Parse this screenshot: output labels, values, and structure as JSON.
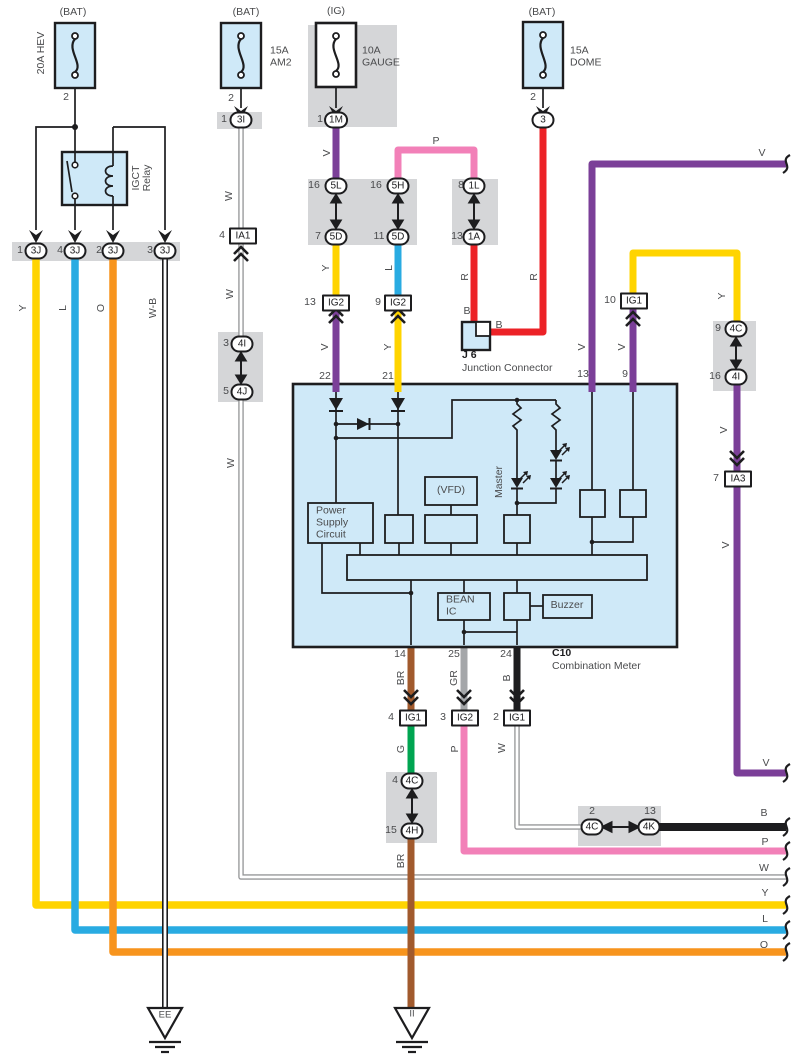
{
  "title": "Combination Meter Wiring Diagram",
  "colors": {
    "yellow": "#FFD400",
    "blue": "#29ABE2",
    "orange": "#F7941D",
    "purple": "#7B3F98",
    "pink": "#F280B8",
    "red": "#EC2227",
    "green": "#00A551",
    "brown": "#A15A2D",
    "gray": "#A4A6A9",
    "black": "#1D1D1F",
    "panel": "#CFE9F8",
    "band": "#D5D6D8",
    "whitewire": "#97989A",
    "line": "#1D1D1F",
    "text": "#4A4B4D"
  },
  "labels": [
    {
      "id": "bat-hev",
      "t": "(BAT)",
      "x": 73,
      "y": 13
    },
    {
      "id": "hev-rating",
      "t": "20A HEV",
      "x": 42,
      "y": 53,
      "c": "r"
    },
    {
      "id": "hev-pin2",
      "t": "2",
      "x": 66,
      "y": 98
    },
    {
      "id": "bat-am2",
      "t": "(BAT)",
      "x": 246,
      "y": 13
    },
    {
      "id": "am2-rating",
      "t": "15A\nAM2",
      "x": 270,
      "y": 57,
      "c": "pre lft"
    },
    {
      "id": "am2-pin2",
      "t": "2",
      "x": 231,
      "y": 99
    },
    {
      "id": "am2-conn-pin",
      "t": "1",
      "x": 224,
      "y": 120
    },
    {
      "id": "conn-3i",
      "t": "3I",
      "x": 241,
      "y": 120,
      "c": "oval"
    },
    {
      "id": "ig-gauge",
      "t": "(IG)",
      "x": 336,
      "y": 12
    },
    {
      "id": "gauge-rating",
      "t": "10A\nGAUGE",
      "x": 362,
      "y": 57,
      "c": "pre lft"
    },
    {
      "id": "gauge-conn-pin",
      "t": "1",
      "x": 320,
      "y": 120
    },
    {
      "id": "conn-1m",
      "t": "1M",
      "x": 336,
      "y": 120,
      "c": "oval"
    },
    {
      "id": "bat-dome",
      "t": "(BAT)",
      "x": 542,
      "y": 13
    },
    {
      "id": "dome-rating",
      "t": "15A\nDOME",
      "x": 570,
      "y": 57,
      "c": "pre lft"
    },
    {
      "id": "dome-pin2",
      "t": "2",
      "x": 533,
      "y": 98
    },
    {
      "id": "conn-3",
      "t": "3",
      "x": 543,
      "y": 120,
      "c": "oval"
    },
    {
      "id": "relay-igct",
      "t": "IGCT",
      "x": 137,
      "y": 178,
      "c": "r"
    },
    {
      "id": "relay-relay",
      "t": "Relay",
      "x": 148,
      "y": 178,
      "c": "r"
    },
    {
      "id": "p3j-1",
      "t": "1",
      "x": 20,
      "y": 251
    },
    {
      "id": "conn-3j-1",
      "t": "3J",
      "x": 36,
      "y": 251,
      "c": "oval"
    },
    {
      "id": "p3j-4",
      "t": "4",
      "x": 60,
      "y": 251
    },
    {
      "id": "conn-3j-4",
      "t": "3J",
      "x": 75,
      "y": 251,
      "c": "oval"
    },
    {
      "id": "p3j-2",
      "t": "2",
      "x": 99,
      "y": 251
    },
    {
      "id": "conn-3j-2",
      "t": "3J",
      "x": 113,
      "y": 251,
      "c": "oval"
    },
    {
      "id": "p3j-3",
      "t": "3",
      "x": 150,
      "y": 251
    },
    {
      "id": "conn-3j-3",
      "t": "3J",
      "x": 165,
      "y": 251,
      "c": "oval"
    },
    {
      "id": "wire-y",
      "t": "Y",
      "x": 24,
      "y": 308,
      "c": "r"
    },
    {
      "id": "wire-l",
      "t": "L",
      "x": 64,
      "y": 308,
      "c": "r"
    },
    {
      "id": "wire-o",
      "t": "O",
      "x": 102,
      "y": 308,
      "c": "r"
    },
    {
      "id": "wire-wb",
      "t": "W-B",
      "x": 154,
      "y": 308,
      "c": "r"
    },
    {
      "id": "wire-w1",
      "t": "W",
      "x": 230,
      "y": 196,
      "c": "r"
    },
    {
      "id": "pia1",
      "t": "4",
      "x": 222,
      "y": 236
    },
    {
      "id": "conn-ia1",
      "t": "IA1",
      "x": 243,
      "y": 236,
      "c": "rect"
    },
    {
      "id": "wire-w2",
      "t": "W",
      "x": 231,
      "y": 294,
      "c": "r"
    },
    {
      "id": "p4i",
      "t": "3",
      "x": 226,
      "y": 344
    },
    {
      "id": "conn-4i",
      "t": "4I",
      "x": 242,
      "y": 344,
      "c": "oval"
    },
    {
      "id": "p4j",
      "t": "5",
      "x": 226,
      "y": 392
    },
    {
      "id": "conn-4j",
      "t": "4J",
      "x": 242,
      "y": 392,
      "c": "oval"
    },
    {
      "id": "wire-w3",
      "t": "W",
      "x": 232,
      "y": 463,
      "c": "r"
    },
    {
      "id": "wire-v1",
      "t": "V",
      "x": 328,
      "y": 153,
      "c": "r"
    },
    {
      "id": "p5l",
      "t": "16",
      "x": 314,
      "y": 186
    },
    {
      "id": "conn-5l",
      "t": "5L",
      "x": 336,
      "y": 186,
      "c": "oval"
    },
    {
      "id": "p5d7",
      "t": "7",
      "x": 318,
      "y": 237
    },
    {
      "id": "conn-5d7",
      "t": "5D",
      "x": 336,
      "y": 237,
      "c": "oval"
    },
    {
      "id": "p5h",
      "t": "16",
      "x": 376,
      "y": 186
    },
    {
      "id": "conn-5h",
      "t": "5H",
      "x": 398,
      "y": 186,
      "c": "oval"
    },
    {
      "id": "p5d11",
      "t": "11",
      "x": 379,
      "y": 237
    },
    {
      "id": "conn-5d11",
      "t": "5D",
      "x": 398,
      "y": 237,
      "c": "oval"
    },
    {
      "id": "wire-p",
      "t": "P",
      "x": 436,
      "y": 142
    },
    {
      "id": "p1l",
      "t": "8",
      "x": 461,
      "y": 186
    },
    {
      "id": "conn-1l",
      "t": "1L",
      "x": 474,
      "y": 186,
      "c": "oval"
    },
    {
      "id": "p1a",
      "t": "13",
      "x": 457,
      "y": 237
    },
    {
      "id": "conn-1a",
      "t": "1A",
      "x": 474,
      "y": 237,
      "c": "oval"
    },
    {
      "id": "wire-y2",
      "t": "Y",
      "x": 327,
      "y": 268,
      "c": "r"
    },
    {
      "id": "wire-l2",
      "t": "L",
      "x": 390,
      "y": 268,
      "c": "r"
    },
    {
      "id": "pig2-13",
      "t": "13",
      "x": 310,
      "y": 303
    },
    {
      "id": "conn-ig2-13",
      "t": "IG2",
      "x": 336,
      "y": 303,
      "c": "rect"
    },
    {
      "id": "pig2-9",
      "t": "9",
      "x": 378,
      "y": 303
    },
    {
      "id": "conn-ig2-9",
      "t": "IG2",
      "x": 398,
      "y": 303,
      "c": "rect"
    },
    {
      "id": "wire-v2",
      "t": "V",
      "x": 326,
      "y": 347,
      "c": "r"
    },
    {
      "id": "wire-y3",
      "t": "Y",
      "x": 389,
      "y": 347,
      "c": "r"
    },
    {
      "id": "pin22",
      "t": "22",
      "x": 325,
      "y": 377
    },
    {
      "id": "pin21",
      "t": "21",
      "x": 388,
      "y": 377
    },
    {
      "id": "wire-r1",
      "t": "R",
      "x": 466,
      "y": 277,
      "c": "r"
    },
    {
      "id": "wire-r2",
      "t": "R",
      "x": 535,
      "y": 277,
      "c": "r"
    },
    {
      "id": "wire-b1",
      "t": "B",
      "x": 467,
      "y": 312
    },
    {
      "id": "wire-b2",
      "t": "B",
      "x": 499,
      "y": 326
    },
    {
      "id": "j6-name",
      "t": "J 6",
      "x": 462,
      "y": 356,
      "c": "b lft"
    },
    {
      "id": "j6-desc",
      "t": "Junction Connector",
      "x": 462,
      "y": 369,
      "c": "lft"
    },
    {
      "id": "wire-v-top",
      "t": "V",
      "x": 762,
      "y": 154
    },
    {
      "id": "pig1-10",
      "t": "10",
      "x": 610,
      "y": 301
    },
    {
      "id": "conn-ig1-10",
      "t": "IG1",
      "x": 634,
      "y": 301,
      "c": "rect"
    },
    {
      "id": "wire-v3",
      "t": "V",
      "x": 583,
      "y": 347,
      "c": "r"
    },
    {
      "id": "wire-v4",
      "t": "V",
      "x": 623,
      "y": 347,
      "c": "r"
    },
    {
      "id": "pin13",
      "t": "13",
      "x": 583,
      "y": 375
    },
    {
      "id": "pin9",
      "t": "9",
      "x": 625,
      "y": 375
    },
    {
      "id": "wire-y4",
      "t": "Y",
      "x": 723,
      "y": 296,
      "c": "r"
    },
    {
      "id": "p4c9",
      "t": "9",
      "x": 718,
      "y": 329
    },
    {
      "id": "conn-4c9",
      "t": "4C",
      "x": 736,
      "y": 329,
      "c": "oval"
    },
    {
      "id": "p4i16",
      "t": "16",
      "x": 715,
      "y": 377
    },
    {
      "id": "conn-4i16",
      "t": "4I",
      "x": 736,
      "y": 377,
      "c": "oval"
    },
    {
      "id": "wire-v5",
      "t": "V",
      "x": 725,
      "y": 430,
      "c": "r"
    },
    {
      "id": "pia3",
      "t": "7",
      "x": 716,
      "y": 479
    },
    {
      "id": "conn-ia3",
      "t": "IA3",
      "x": 738,
      "y": 479,
      "c": "rect"
    },
    {
      "id": "wire-v6",
      "t": "V",
      "x": 727,
      "y": 545,
      "c": "r"
    },
    {
      "id": "master",
      "t": "Master",
      "x": 500,
      "y": 482,
      "c": "r"
    },
    {
      "id": "vfd",
      "t": "(VFD)",
      "x": 451,
      "y": 491
    },
    {
      "id": "psu",
      "t": "Power\nSupply\nCircuit",
      "x": 316,
      "y": 523,
      "c": "pre lft"
    },
    {
      "id": "bean",
      "t": "BEAN\nIC",
      "x": 446,
      "y": 606,
      "c": "pre lft"
    },
    {
      "id": "buzzer",
      "t": "Buzzer",
      "x": 567,
      "y": 606
    },
    {
      "id": "pin14",
      "t": "14",
      "x": 400,
      "y": 655
    },
    {
      "id": "pin25",
      "t": "25",
      "x": 454,
      "y": 655
    },
    {
      "id": "pin24",
      "t": "24",
      "x": 506,
      "y": 655
    },
    {
      "id": "c10",
      "t": "C10",
      "x": 552,
      "y": 654,
      "c": "b lft"
    },
    {
      "id": "c10-desc",
      "t": "Combination Meter",
      "x": 552,
      "y": 667,
      "c": "lft"
    },
    {
      "id": "wire-br1",
      "t": "BR",
      "x": 402,
      "y": 678,
      "c": "r"
    },
    {
      "id": "wire-gr",
      "t": "GR",
      "x": 455,
      "y": 678,
      "c": "r"
    },
    {
      "id": "wire-b3",
      "t": "B",
      "x": 508,
      "y": 678,
      "c": "r"
    },
    {
      "id": "pig1-4",
      "t": "4",
      "x": 391,
      "y": 718
    },
    {
      "id": "conn-ig1-4",
      "t": "IG1",
      "x": 413,
      "y": 718,
      "c": "rect"
    },
    {
      "id": "pig2-3",
      "t": "3",
      "x": 443,
      "y": 718
    },
    {
      "id": "conn-ig2-3",
      "t": "IG2",
      "x": 465,
      "y": 718,
      "c": "rect"
    },
    {
      "id": "pig1-2",
      "t": "2",
      "x": 496,
      "y": 718
    },
    {
      "id": "conn-ig1-2",
      "t": "IG1",
      "x": 517,
      "y": 718,
      "c": "rect"
    },
    {
      "id": "wire-g",
      "t": "G",
      "x": 402,
      "y": 749,
      "c": "r"
    },
    {
      "id": "wire-p2",
      "t": "P",
      "x": 456,
      "y": 749,
      "c": "r"
    },
    {
      "id": "wire-w4",
      "t": "W",
      "x": 503,
      "y": 748,
      "c": "r"
    },
    {
      "id": "p4c4",
      "t": "4",
      "x": 395,
      "y": 781
    },
    {
      "id": "conn-4c4",
      "t": "4C",
      "x": 412,
      "y": 781,
      "c": "oval"
    },
    {
      "id": "p4h",
      "t": "15",
      "x": 391,
      "y": 831
    },
    {
      "id": "conn-4h",
      "t": "4H",
      "x": 412,
      "y": 831,
      "c": "oval"
    },
    {
      "id": "wire-br2",
      "t": "BR",
      "x": 402,
      "y": 861,
      "c": "r"
    },
    {
      "id": "p4c2",
      "t": "2",
      "x": 592,
      "y": 812
    },
    {
      "id": "p4k",
      "t": "13",
      "x": 650,
      "y": 812
    },
    {
      "id": "conn-4c2",
      "t": "4C",
      "x": 592,
      "y": 827,
      "c": "oval"
    },
    {
      "id": "conn-4k",
      "t": "4K",
      "x": 649,
      "y": 827,
      "c": "oval"
    },
    {
      "id": "wire-v7",
      "t": "V",
      "x": 766,
      "y": 764
    },
    {
      "id": "wire-b4",
      "t": "B",
      "x": 764,
      "y": 814
    },
    {
      "id": "wire-p3",
      "t": "P",
      "x": 765,
      "y": 843
    },
    {
      "id": "wire-w5",
      "t": "W",
      "x": 764,
      "y": 869
    },
    {
      "id": "wire-y5",
      "t": "Y",
      "x": 765,
      "y": 894
    },
    {
      "id": "wire-l3",
      "t": "L",
      "x": 765,
      "y": 920
    },
    {
      "id": "wire-o2",
      "t": "O",
      "x": 764,
      "y": 946
    },
    {
      "id": "gnd-ee",
      "t": "EE",
      "x": 165,
      "y": 1016,
      "c": "gnd"
    },
    {
      "id": "gnd-ii",
      "t": "II",
      "x": 412,
      "y": 1015,
      "c": "gnd"
    }
  ]
}
